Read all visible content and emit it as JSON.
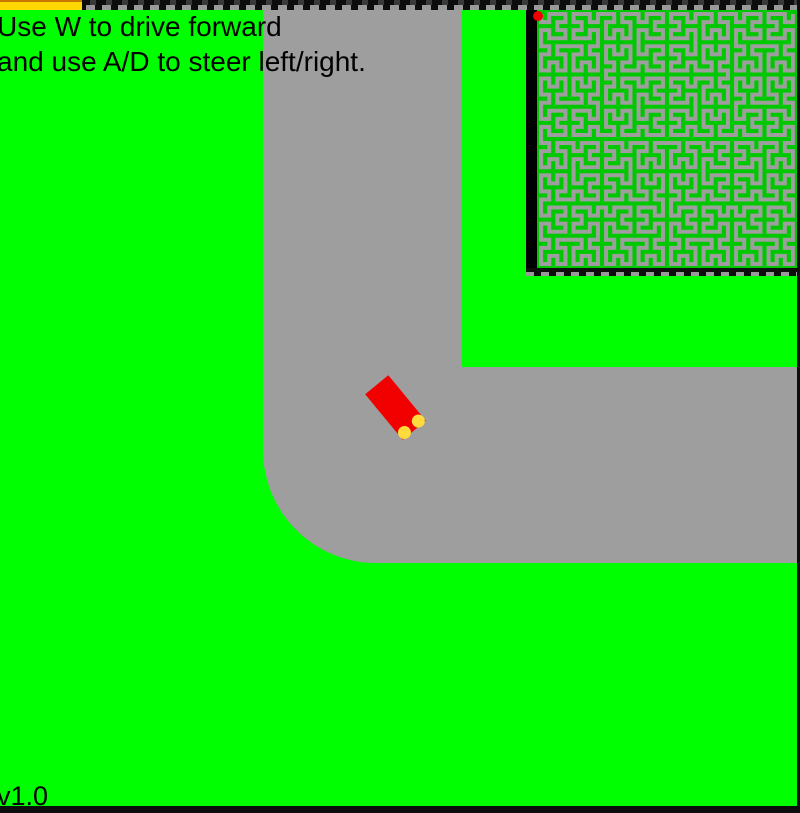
{
  "hud": {
    "instructions_line1": "Use W to drive forward",
    "instructions_line2": "and use A/D to steer left/right.",
    "version_label": "v1.0"
  },
  "colors": {
    "grass": "#00FF00",
    "road": "#9E9E9E",
    "car_body": "#F20000",
    "car_light": "#FFDC3C",
    "progress_bar": "#FFD700",
    "progress_bar_top": "#C87800",
    "minimap_bg": "#00C800",
    "minimap_path": "#9E9E9E",
    "player_marker": "#EE0000",
    "wall_gray": "#9A9A9A"
  },
  "road": {
    "path": "M263,0 L263,450 A113,113 0 0 0 376,563 L800,563 L800,367 L462,367 L462,0 Z"
  },
  "car": {
    "cx": 395.5,
    "cy": 407.5,
    "width": 30,
    "length": 59,
    "rotation_deg": -39.5,
    "light_offset_x": 9,
    "light_offset_y": 25,
    "light_radius": 6.5
  },
  "progress_bar": {
    "left": 0,
    "top": 0,
    "width": 82,
    "height": 10
  },
  "minimap": {
    "left": 526,
    "top": 10,
    "width": 274,
    "height": 266,
    "border_left": 11,
    "border_right": 3,
    "border_bottom": 8,
    "inner_width": 260,
    "inner_height": 258,
    "hilbert_order": 5,
    "marker": {
      "left": 7,
      "top": 1,
      "size": 10
    }
  }
}
